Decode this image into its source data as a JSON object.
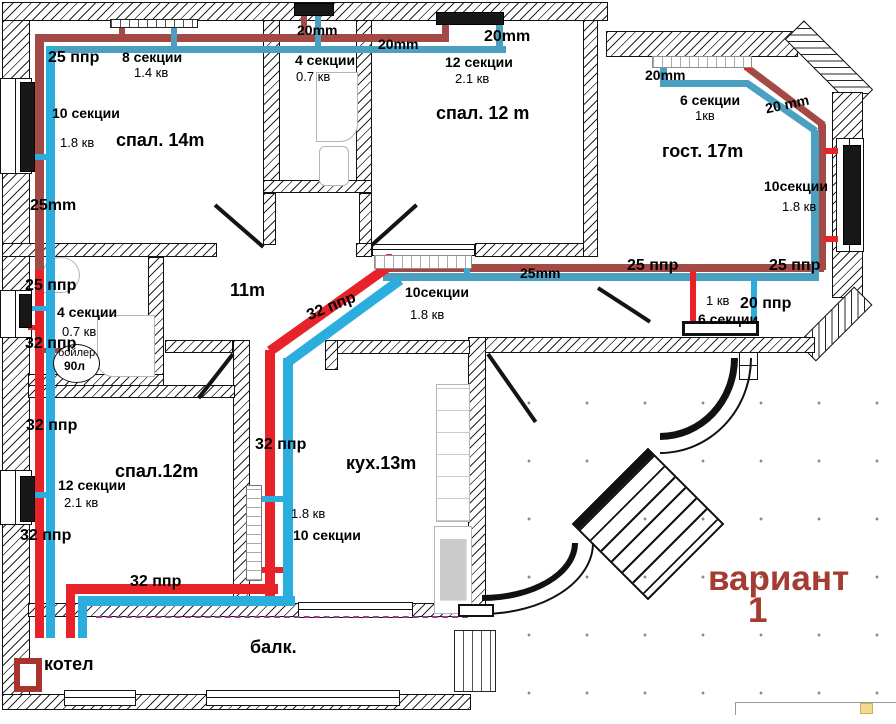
{
  "variant": {
    "line1": "вариант",
    "line2": "1"
  },
  "colors": {
    "red_bright": "#e82229",
    "red_brick": "#a34a46",
    "blue_bright": "#2badde",
    "blue_teal": "#4b9fc0",
    "variant_text": "#a43c31"
  },
  "rooms": [
    {
      "name": "спал. 14m"
    },
    {
      "name": "спал. 12 m"
    },
    {
      "name": "гост. 17m"
    },
    {
      "name": "11m"
    },
    {
      "name": "спал.12m"
    },
    {
      "name": "кух.13m"
    },
    {
      "name": "балк."
    },
    {
      "name": "котел"
    }
  ],
  "equipment": {
    "boiler_tank_line1": "бойлер",
    "boiler_tank_line2": "90л",
    "heating_boiler": "котел"
  },
  "labels": [
    {
      "text": "25 ппр",
      "x": 48,
      "y": 50,
      "cls": "pipe-l"
    },
    {
      "text": "8 секции",
      "x": 122,
      "y": 50,
      "cls": "sect"
    },
    {
      "text": "1.4 кв",
      "x": 134,
      "y": 66,
      "cls": "kv"
    },
    {
      "text": "10 секции",
      "x": 52,
      "y": 106,
      "cls": "sect"
    },
    {
      "text": "1.8 кв",
      "x": 60,
      "y": 136,
      "cls": "kv"
    },
    {
      "text": "спал. 14m",
      "x": 116,
      "y": 131,
      "cls": "room"
    },
    {
      "text": "25mm",
      "x": 30,
      "y": 198,
      "cls": "pipe-l"
    },
    {
      "text": "20mm",
      "x": 297,
      "y": 23,
      "cls": "sect"
    },
    {
      "text": "4 секции",
      "x": 295,
      "y": 53,
      "cls": "sect"
    },
    {
      "text": "0.7 кв",
      "x": 296,
      "y": 70,
      "cls": "kv"
    },
    {
      "text": "20mm",
      "x": 378,
      "y": 37,
      "cls": "sect"
    },
    {
      "text": "20mm",
      "x": 484,
      "y": 29,
      "cls": "pipe-l"
    },
    {
      "text": "12 секции",
      "x": 445,
      "y": 55,
      "cls": "sect"
    },
    {
      "text": "2.1 кв",
      "x": 455,
      "y": 72,
      "cls": "kv"
    },
    {
      "text": "спал. 12 m",
      "x": 436,
      "y": 104,
      "cls": "room"
    },
    {
      "text": "20mm",
      "x": 645,
      "y": 68,
      "cls": "sect"
    },
    {
      "text": "6 секции",
      "x": 680,
      "y": 93,
      "cls": "sect"
    },
    {
      "text": "1кв",
      "x": 695,
      "y": 109,
      "cls": "kv"
    },
    {
      "text": "20 mm",
      "x": 765,
      "y": 97,
      "cls": "sect",
      "rot": -12
    },
    {
      "text": "гост. 17m",
      "x": 662,
      "y": 142,
      "cls": "room"
    },
    {
      "text": "10секции",
      "x": 764,
      "y": 179,
      "cls": "sect"
    },
    {
      "text": "1.8 кв",
      "x": 782,
      "y": 200,
      "cls": "kv"
    },
    {
      "text": "25 ппр",
      "x": 25,
      "y": 278,
      "cls": "pipe-l"
    },
    {
      "text": "4 секции",
      "x": 57,
      "y": 305,
      "cls": "sect"
    },
    {
      "text": "0.7 кв",
      "x": 62,
      "y": 325,
      "cls": "kv"
    },
    {
      "text": "32 ппр",
      "x": 25,
      "y": 336,
      "cls": "pipe-l"
    },
    {
      "text": "11m",
      "x": 230,
      "y": 281,
      "cls": "room"
    },
    {
      "text": "10секции",
      "x": 405,
      "y": 285,
      "cls": "sect"
    },
    {
      "text": "1.8 кв",
      "x": 410,
      "y": 308,
      "cls": "kv"
    },
    {
      "text": "32 ппр",
      "x": 306,
      "y": 299,
      "cls": "pipe-l",
      "rot": -22
    },
    {
      "text": "25mm",
      "x": 520,
      "y": 266,
      "cls": "sect"
    },
    {
      "text": "25 ппр",
      "x": 627,
      "y": 258,
      "cls": "pipe-l"
    },
    {
      "text": "25 ппр",
      "x": 769,
      "y": 258,
      "cls": "pipe-l"
    },
    {
      "text": "1 кв",
      "x": 706,
      "y": 294,
      "cls": "kv"
    },
    {
      "text": "20 ппр",
      "x": 740,
      "y": 296,
      "cls": "pipe-l"
    },
    {
      "text": "6 секции",
      "x": 698,
      "y": 312,
      "cls": "sect"
    },
    {
      "text": "32 ппр",
      "x": 26,
      "y": 418,
      "cls": "pipe-l"
    },
    {
      "text": "спал.12m",
      "x": 115,
      "y": 462,
      "cls": "room"
    },
    {
      "text": "12 секции",
      "x": 58,
      "y": 478,
      "cls": "sect"
    },
    {
      "text": "2.1 кв",
      "x": 64,
      "y": 496,
      "cls": "kv"
    },
    {
      "text": "32 ппр",
      "x": 20,
      "y": 528,
      "cls": "pipe-l"
    },
    {
      "text": "32 ппр",
      "x": 255,
      "y": 437,
      "cls": "pipe-l"
    },
    {
      "text": "кух.13m",
      "x": 346,
      "y": 454,
      "cls": "room"
    },
    {
      "text": "1.8 кв",
      "x": 291,
      "y": 507,
      "cls": "kv"
    },
    {
      "text": "10 секции",
      "x": 293,
      "y": 528,
      "cls": "sect"
    },
    {
      "text": "32 ппр",
      "x": 130,
      "y": 574,
      "cls": "pipe-l"
    },
    {
      "text": "котел",
      "x": 44,
      "y": 655,
      "cls": "room"
    },
    {
      "text": "балк.",
      "x": 250,
      "y": 638,
      "cls": "room"
    },
    {
      "text": "бойлер",
      "x": 58,
      "y": 348,
      "cls": "small"
    },
    {
      "text": "90л",
      "x": 64,
      "y": 360,
      "cls": "smallb"
    },
    {
      "text": "вариант",
      "x": 708,
      "y": 561,
      "cls": "big"
    },
    {
      "text": "1",
      "x": 748,
      "y": 593,
      "cls": "big"
    }
  ]
}
